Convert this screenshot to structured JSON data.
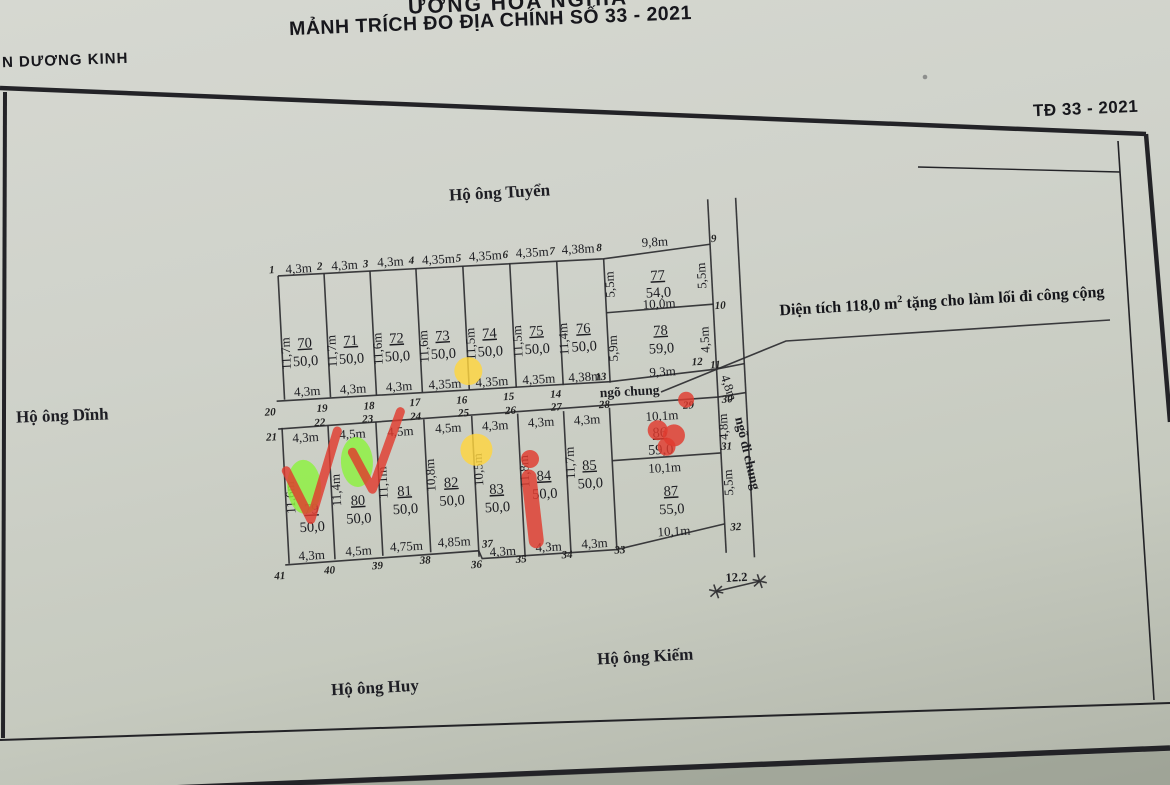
{
  "colors": {
    "paper": "#cfd2ca",
    "ink": "#2c2c30",
    "marker_red": "#e03a2e",
    "marker_green": "#8cf23e",
    "marker_yellow": "#ffd63e"
  },
  "header": {
    "top_partial": "ƯỜNG HÒA NGHĨA",
    "title": "MẢNH TRÍCH ĐO ĐỊA CHÍNH SỐ 33 - 2021",
    "left_partial": "N DƯƠNG KINH",
    "sheet_label": "TĐ 33 - 2021"
  },
  "neighbors": {
    "top": "Hộ ông Tuyển",
    "left": "Hộ ông Dĩnh",
    "bottom_left": "Hộ ông Huy",
    "bottom_right": "Hộ ông Kiếm"
  },
  "note": {
    "pre": "Diện tích 118,0 m",
    "sup": "2",
    "post": " tặng cho làm lối đi công cộng"
  },
  "lanes": {
    "horizontal": "ngõ chung",
    "vertical": "ngõ đi chung",
    "width": "4,8m",
    "bottom_width_mark": "12.2"
  },
  "parcels": {
    "row1": [
      {
        "id": "70",
        "area": "50,0",
        "top": "4,3m",
        "bottom": "4,3m",
        "left": "11,7m"
      },
      {
        "id": "71",
        "area": "50,0",
        "top": "4,3m",
        "bottom": "4,3m",
        "left": "11,7m"
      },
      {
        "id": "72",
        "area": "50,0",
        "top": "4,3m",
        "bottom": "4,3m",
        "left": "11,6m"
      },
      {
        "id": "73",
        "area": "50,0",
        "top": "4,35m",
        "bottom": "4,35m",
        "left": "11,6m"
      },
      {
        "id": "74",
        "area": "50,0",
        "top": "4,35m",
        "bottom": "4,35m",
        "left": "11,5m"
      },
      {
        "id": "75",
        "area": "50,0",
        "top": "4,35m",
        "bottom": "4,35m",
        "left": "11,5m"
      },
      {
        "id": "76",
        "area": "50,0",
        "top": "4,38m",
        "bottom": "4,38m",
        "left": "11,4m"
      }
    ],
    "p77": {
      "id": "77",
      "area": "54,0",
      "top": "9,8m",
      "left": "5,5m",
      "right": "5,5m",
      "bottom": "10,0m"
    },
    "p78": {
      "id": "78",
      "area": "59,0",
      "left": "5,9m",
      "right": "4,5m",
      "bottom": "9,3m"
    },
    "row2": [
      {
        "id": "79",
        "area": "50,0",
        "top": "4,3m",
        "bottom": "4,3m",
        "left": "11,6m"
      },
      {
        "id": "80",
        "area": "50,0",
        "top": "4,5m",
        "bottom": "4,5m",
        "left": "11,4m"
      },
      {
        "id": "81",
        "area": "50,0",
        "top": "4,5m",
        "bottom": "4,75m",
        "left": "11,1m"
      },
      {
        "id": "82",
        "area": "50,0",
        "top": "4,5m",
        "bottom": "4,85m",
        "left": "10,8m"
      },
      {
        "id": "83",
        "area": "50,0",
        "top": "4,3m",
        "bottom": "4,3m",
        "left": "10,5m"
      },
      {
        "id": "84",
        "area": "50,0",
        "top": "4,3m",
        "bottom": "4,3m",
        "left": "11,8m"
      },
      {
        "id": "85",
        "area": "50,0",
        "top": "4,3m",
        "bottom": "4,3m",
        "left": "11,7m"
      }
    ],
    "p86": {
      "id": "86",
      "area": "59,0",
      "top": "10,1m",
      "right": "4,8m",
      "bottom": "10,1m"
    },
    "p87": {
      "id": "87",
      "area": "55,0",
      "right": "5,5m",
      "bottom": "10,1m"
    }
  },
  "corners": {
    "c1": "1",
    "c2": "2",
    "c3": "3",
    "c4": "4",
    "c5": "5",
    "c6": "6",
    "c7": "7",
    "c8": "8",
    "c9": "9",
    "c10": "10",
    "c11": "11",
    "c12": "12",
    "c13": "13",
    "c14": "14",
    "c15": "15",
    "c16": "16",
    "c17": "17",
    "c18": "18",
    "c19": "19",
    "c20": "20",
    "c21": "21",
    "c22": "22",
    "c23": "23",
    "c24": "24",
    "c25": "25",
    "c26": "26",
    "c27": "27",
    "c28": "28",
    "c29": "29",
    "c30": "30",
    "c31": "31",
    "c32": "32",
    "c33": "33",
    "c34": "34",
    "c35": "35",
    "c36": "36",
    "c37": "37",
    "c38": "38",
    "c39": "39",
    "c40": "40",
    "c41": "41"
  }
}
